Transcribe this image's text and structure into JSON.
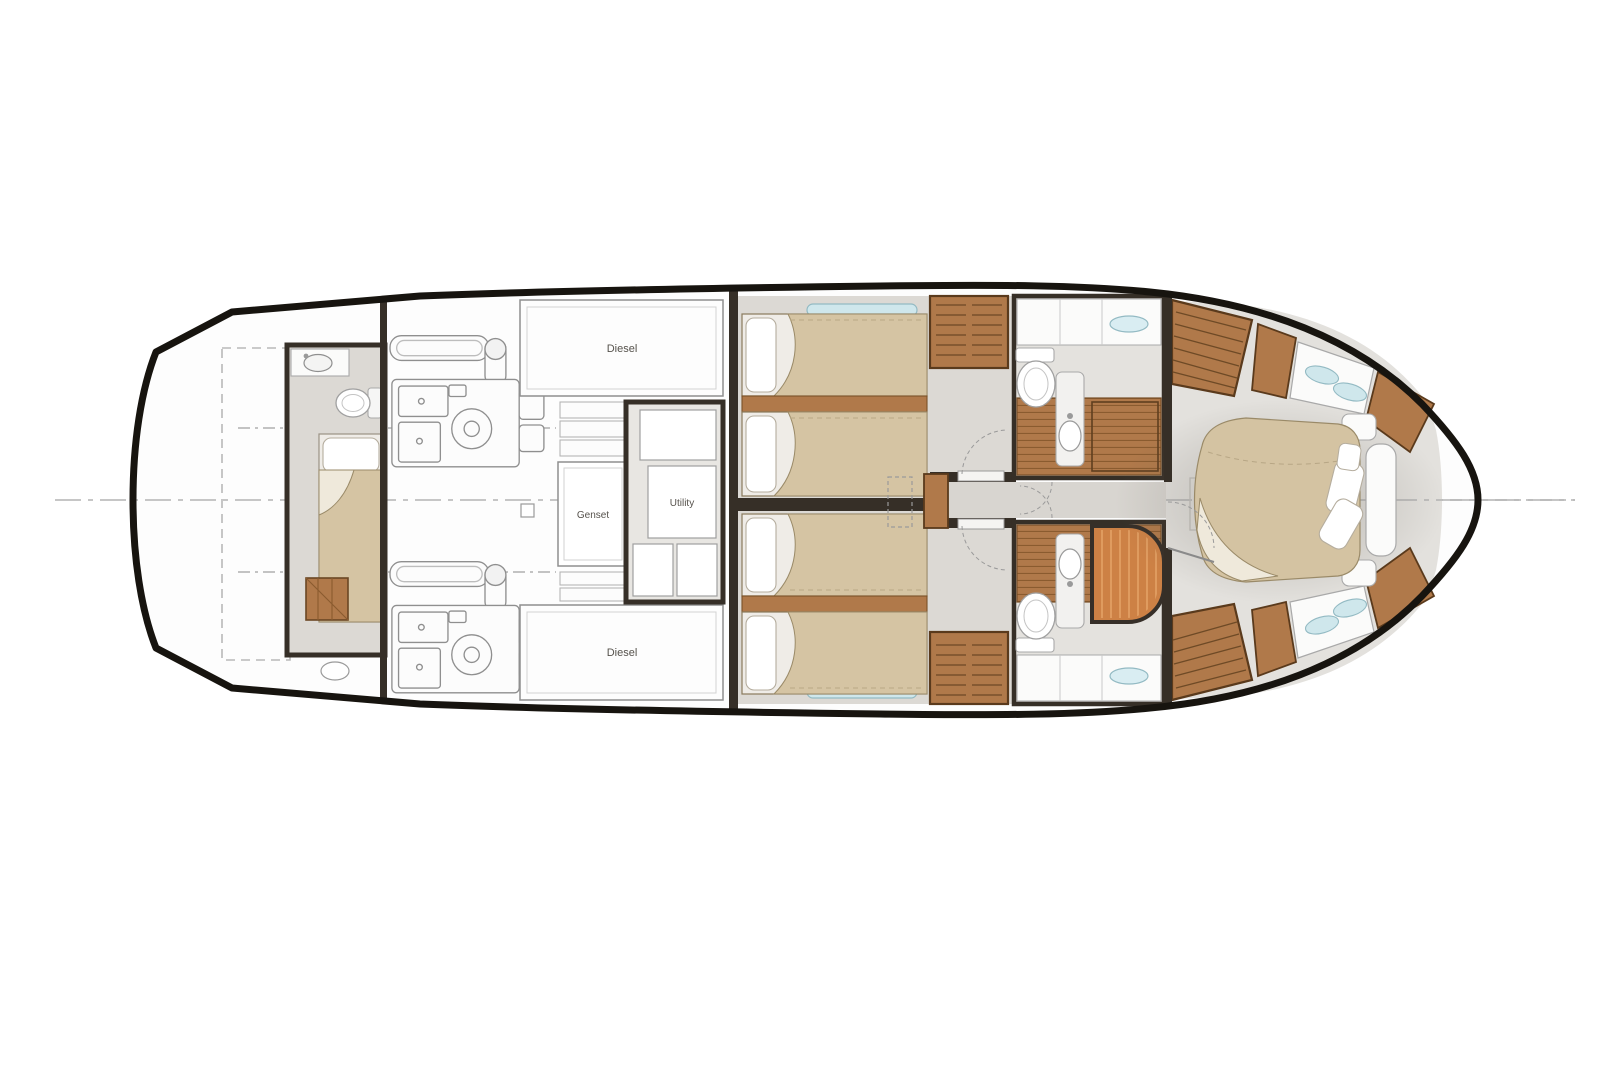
{
  "diagram": {
    "type": "yacht-lower-deck-floor-plan",
    "orientation": "bow-right",
    "labels": {
      "tank_upper": "Diesel",
      "genset": "Genset",
      "utility": "Utility",
      "tank_lower": "Diesel"
    },
    "colors": {
      "background": "#ffffff",
      "hull_outline": "#17140f",
      "wall": "#362f27",
      "floor": "#dcd9d4",
      "wood": "#b0794a",
      "wood_dark": "#6e4a26",
      "bedding_tan": "#d5c4a3",
      "pillow_white": "#ffffff",
      "window_blue": "#cfe7ec",
      "shower_orange": "#cd8145",
      "lineart_gray": "#8f8f8f",
      "label_text": "#56524c"
    }
  }
}
